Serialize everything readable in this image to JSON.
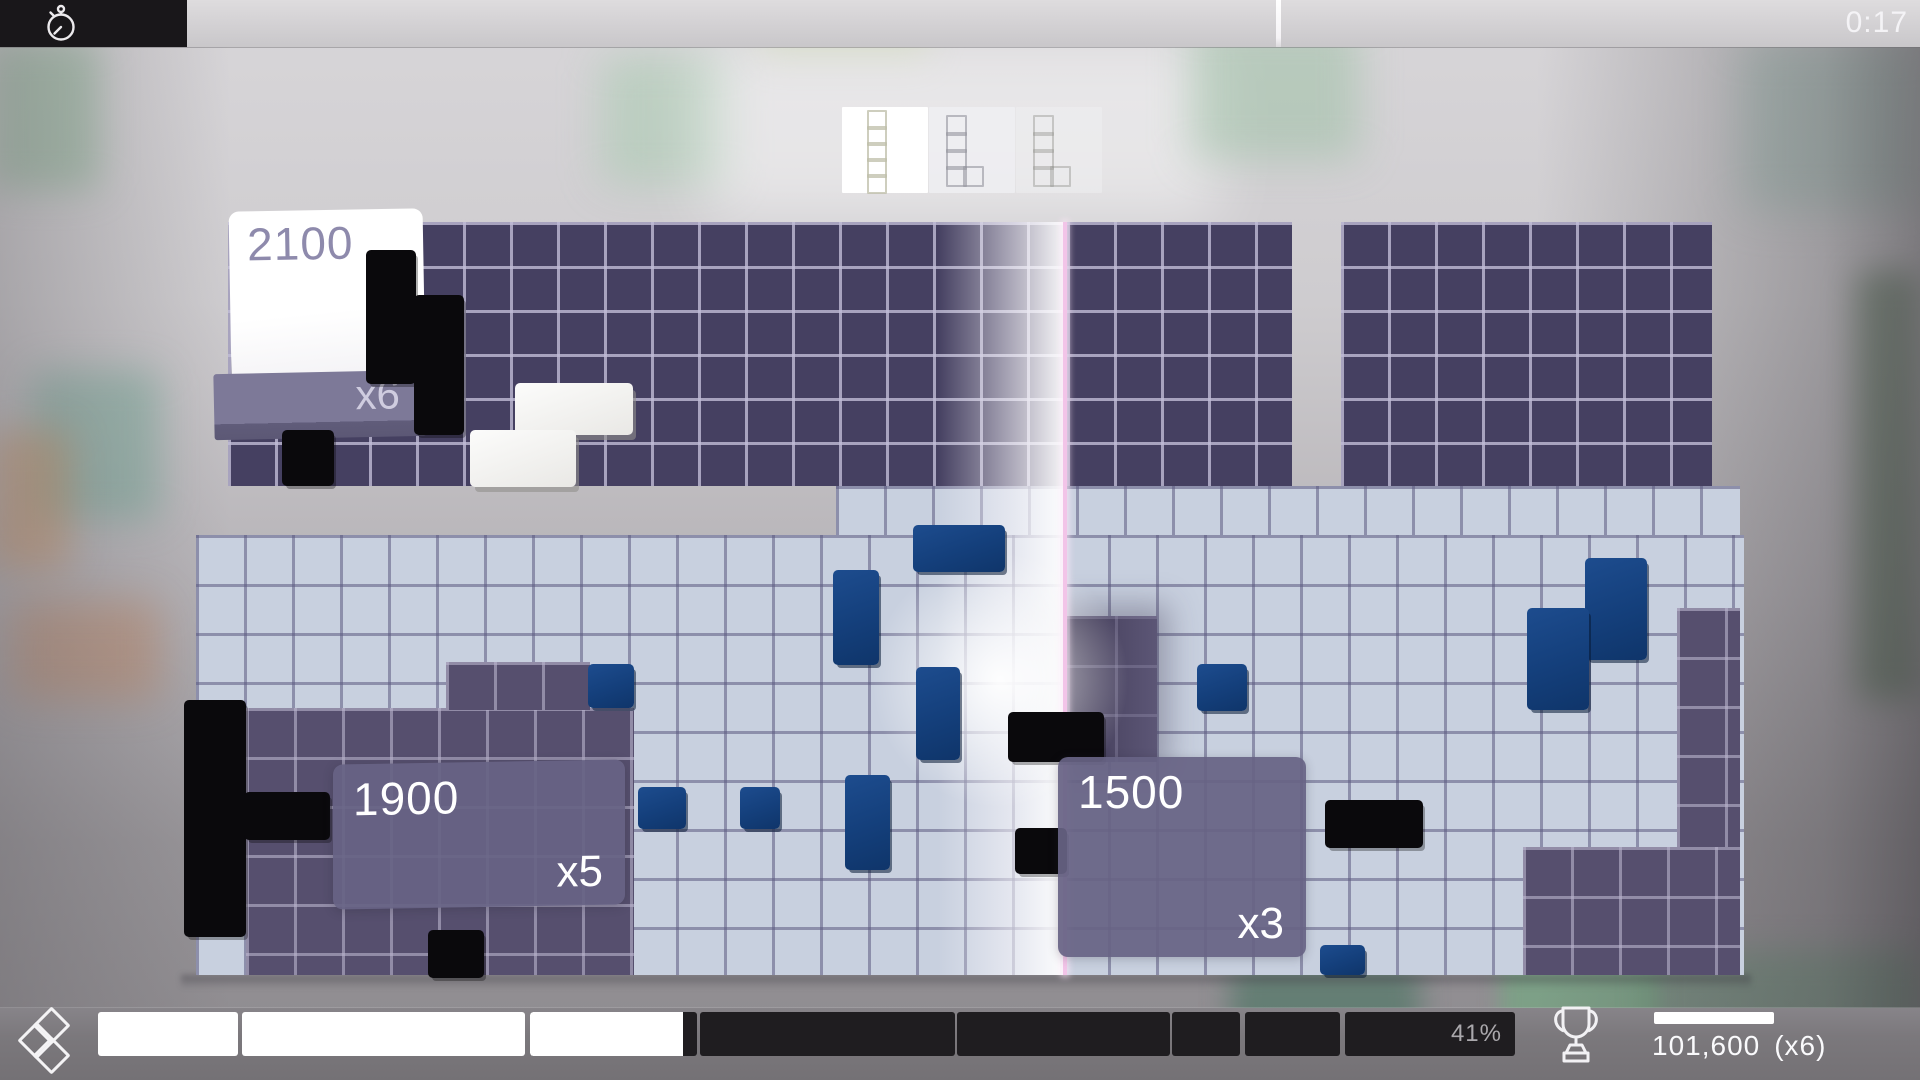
{
  "top_bar": {
    "timer": "0:17"
  },
  "previews": {
    "shapes": {
      "I5": [
        [
          0,
          0
        ],
        [
          0,
          1
        ],
        [
          0,
          2
        ],
        [
          0,
          3
        ],
        [
          0,
          4
        ]
      ],
      "L5": [
        [
          0,
          0
        ],
        [
          0,
          1
        ],
        [
          0,
          2
        ],
        [
          0,
          3
        ],
        [
          1,
          3
        ]
      ]
    },
    "boxes": [
      {
        "piece": "I5",
        "bg": "rgba(255,255,255,1)",
        "outline": "rgba(190,190,168,0.75)"
      },
      {
        "piece": "L5",
        "bg": "rgba(240,240,244,0.78)",
        "outline": "rgba(148,148,158,0.6)"
      },
      {
        "piece": "L5",
        "bg": "rgba(240,240,242,0.5)",
        "outline": "rgba(150,150,146,0.45)"
      }
    ]
  },
  "field": {
    "regions": [
      {
        "name": "top-section-left",
        "kind": "dark",
        "x": 228,
        "y": 222,
        "w": 839,
        "h": 264
      },
      {
        "name": "top-section-mid",
        "kind": "dark",
        "x": 1067,
        "y": 222,
        "w": 225,
        "h": 264
      },
      {
        "name": "top-section-right",
        "kind": "dark",
        "x": 1341,
        "y": 222,
        "w": 371,
        "h": 264
      },
      {
        "name": "light-row-top",
        "kind": "light",
        "x": 836,
        "y": 486,
        "w": 904,
        "h": 49
      },
      {
        "name": "light-main",
        "kind": "light",
        "x": 196,
        "y": 535,
        "w": 1548,
        "h": 440
      },
      {
        "name": "purple-bottom-left",
        "kind": "purple",
        "x": 246,
        "y": 708,
        "w": 388,
        "h": 267
      },
      {
        "name": "purple-notch",
        "kind": "purple",
        "x": 446,
        "y": 662,
        "w": 144,
        "h": 48
      },
      {
        "name": "purple-right-of-sweep",
        "kind": "purple-shadow",
        "x": 1067,
        "y": 616,
        "w": 90,
        "h": 146
      },
      {
        "name": "purple-right-strip",
        "kind": "purple",
        "x": 1677,
        "y": 608,
        "w": 63,
        "h": 367
      },
      {
        "name": "purple-bottom-right",
        "kind": "purple",
        "x": 1523,
        "y": 847,
        "w": 217,
        "h": 128
      }
    ],
    "blocks": [
      {
        "color": "black",
        "x": 366,
        "y": 250,
        "w": 50,
        "h": 134
      },
      {
        "color": "black",
        "x": 414,
        "y": 295,
        "w": 50,
        "h": 140
      },
      {
        "color": "black",
        "x": 282,
        "y": 430,
        "w": 52,
        "h": 56
      },
      {
        "color": "white",
        "x": 515,
        "y": 383,
        "w": 118,
        "h": 52
      },
      {
        "color": "white",
        "x": 470,
        "y": 430,
        "w": 106,
        "h": 57
      },
      {
        "color": "navy",
        "x": 913,
        "y": 525,
        "w": 92,
        "h": 47
      },
      {
        "color": "navy",
        "x": 833,
        "y": 570,
        "w": 46,
        "h": 95
      },
      {
        "color": "navy",
        "x": 916,
        "y": 667,
        "w": 44,
        "h": 93
      },
      {
        "color": "navy",
        "x": 1197,
        "y": 664,
        "w": 50,
        "h": 47
      },
      {
        "color": "navy",
        "x": 588,
        "y": 664,
        "w": 46,
        "h": 44
      },
      {
        "color": "navy",
        "x": 638,
        "y": 787,
        "w": 48,
        "h": 42
      },
      {
        "color": "navy",
        "x": 740,
        "y": 787,
        "w": 40,
        "h": 42
      },
      {
        "color": "navy",
        "x": 845,
        "y": 775,
        "w": 45,
        "h": 95
      },
      {
        "color": "navy",
        "x": 1320,
        "y": 945,
        "w": 45,
        "h": 30
      },
      {
        "color": "navy",
        "x": 1585,
        "y": 558,
        "w": 62,
        "h": 102
      },
      {
        "color": "navy",
        "x": 1527,
        "y": 608,
        "w": 62,
        "h": 102
      },
      {
        "color": "black",
        "x": 184,
        "y": 700,
        "w": 62,
        "h": 237
      },
      {
        "color": "black",
        "x": 244,
        "y": 792,
        "w": 86,
        "h": 48
      },
      {
        "color": "black",
        "x": 428,
        "y": 930,
        "w": 56,
        "h": 48
      },
      {
        "color": "black",
        "x": 1008,
        "y": 712,
        "w": 96,
        "h": 50
      },
      {
        "color": "black",
        "x": 1015,
        "y": 828,
        "w": 52,
        "h": 46
      },
      {
        "color": "black",
        "x": 1325,
        "y": 800,
        "w": 98,
        "h": 48
      }
    ],
    "popups": {
      "card": {
        "score": "2100",
        "multiplier": "x6"
      },
      "left": {
        "score": "1900",
        "multiplier": "x5"
      },
      "right": {
        "score": "1500",
        "multiplier": "x3"
      }
    }
  },
  "bottom_bar": {
    "segments": [
      {
        "state": "filled",
        "x": 98,
        "w": 140
      },
      {
        "state": "filled",
        "x": 242,
        "w": 283
      },
      {
        "state": "partial",
        "x": 530,
        "w": 167,
        "fill_w": 153
      },
      {
        "state": "empty",
        "x": 700,
        "w": 255
      },
      {
        "state": "empty",
        "x": 957,
        "w": 213
      },
      {
        "state": "empty",
        "x": 1172,
        "w": 68
      },
      {
        "state": "empty",
        "x": 1245,
        "w": 95
      },
      {
        "state": "empty",
        "x": 1345,
        "w": 170,
        "label": "41%"
      }
    ],
    "score": {
      "value": "101,600",
      "multiplier": "(x6)"
    }
  },
  "colors": {
    "dark_cell": "#454061",
    "light_cell": "#c8d0df",
    "purple_cell": "#564f6e",
    "navy_block": "#143f7b",
    "black_block": "#0a090c",
    "white_block": "#f4f3f1",
    "sweep_line": "#f2c4e8",
    "popup_bg": "#676384",
    "segment_filled": "#ffffff",
    "segment_empty": "#1f1d20",
    "hud_bar": "#7b787c"
  },
  "bokeh": [
    {
      "x": -10,
      "y": 40,
      "w": 110,
      "h": 150,
      "c": "rgba(125,175,135,0.45)",
      "b": 18
    },
    {
      "x": 30,
      "y": 370,
      "w": 130,
      "h": 150,
      "c": "rgba(95,165,140,0.40)",
      "b": 18
    },
    {
      "x": -10,
      "y": 430,
      "w": 80,
      "h": 140,
      "c": "rgba(205,145,95,0.50)",
      "b": 18
    },
    {
      "x": 10,
      "y": 600,
      "w": 150,
      "h": 100,
      "c": "rgba(200,120,70,0.35)",
      "b": 20
    },
    {
      "x": 600,
      "y": 55,
      "w": 130,
      "h": 130,
      "c": "rgba(150,200,160,0.38)",
      "b": 20
    },
    {
      "x": 760,
      "y": 0,
      "w": 170,
      "h": 60,
      "c": "rgba(190,210,150,0.35)",
      "b": 16
    },
    {
      "x": 700,
      "y": 40,
      "w": 520,
      "h": 180,
      "c": "rgba(255,255,255,0.45)",
      "b": 30
    },
    {
      "x": 1190,
      "y": 20,
      "w": 170,
      "h": 140,
      "c": "rgba(135,185,145,0.38)",
      "b": 20
    },
    {
      "x": 1740,
      "y": 40,
      "w": 180,
      "h": 170,
      "c": "rgba(125,175,155,0.32)",
      "b": 22
    },
    {
      "x": 1856,
      "y": 270,
      "w": 64,
      "h": 430,
      "c": "rgba(75,110,75,0.50)",
      "b": 16
    },
    {
      "x": 1500,
      "y": 955,
      "w": 160,
      "h": 120,
      "c": "rgba(110,175,125,0.55)",
      "b": 10
    },
    {
      "x": 1230,
      "y": 965,
      "w": 190,
      "h": 115,
      "c": "rgba(55,110,85,0.50)",
      "b": 14
    },
    {
      "x": 1650,
      "y": 950,
      "w": 270,
      "h": 130,
      "c": "rgba(80,140,100,0.35)",
      "b": 16
    }
  ]
}
